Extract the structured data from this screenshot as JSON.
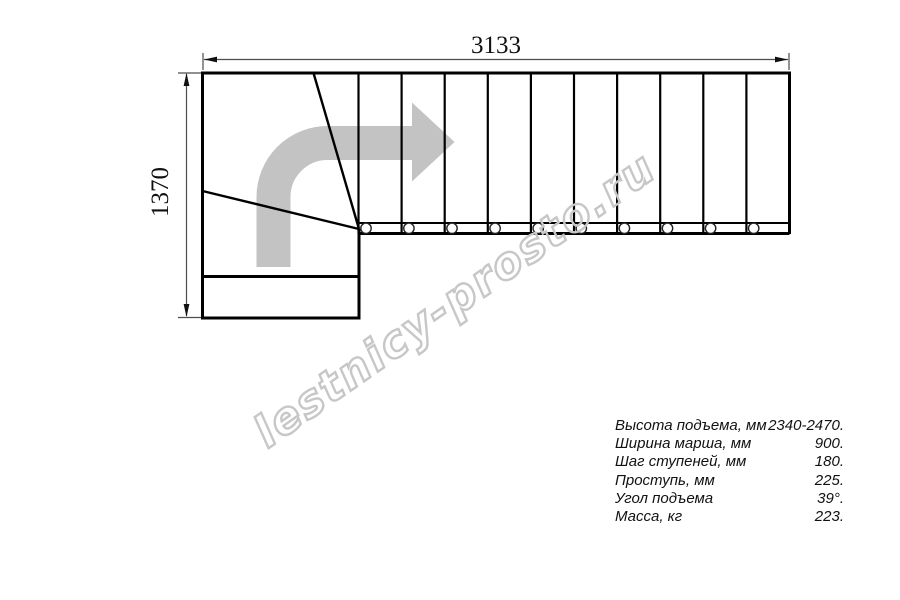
{
  "title": "Staircase plan drawing",
  "dimensions": {
    "top_width_mm": "3133",
    "left_depth_mm": "1370"
  },
  "watermark_text": "lestnicy-prosto.ru",
  "specs": {
    "rows": [
      {
        "label": "Высота подъема, мм",
        "value": "2340-2470."
      },
      {
        "label": "Ширина марша, мм",
        "value": "900."
      },
      {
        "label": "Шаг ступеней, мм",
        "value": "180."
      },
      {
        "label": "Проступь, мм",
        "value": "225."
      },
      {
        "label": "Угол подъема",
        "value": "39°."
      },
      {
        "label": "Масса, кг",
        "value": "223."
      }
    ]
  },
  "drawing": {
    "step_count_straight_flight": 10,
    "baluster_count": 10,
    "winder_turn": "90-degree left-to-right turn",
    "direction_arrow": "up then right"
  },
  "colors": {
    "outline": "#000000",
    "dimension_line": "#4d4d4d",
    "direction_arrow_gray": "#c3c3c3",
    "watermark_outline_gray": "#c7c7c7",
    "background": "#ffffff"
  }
}
